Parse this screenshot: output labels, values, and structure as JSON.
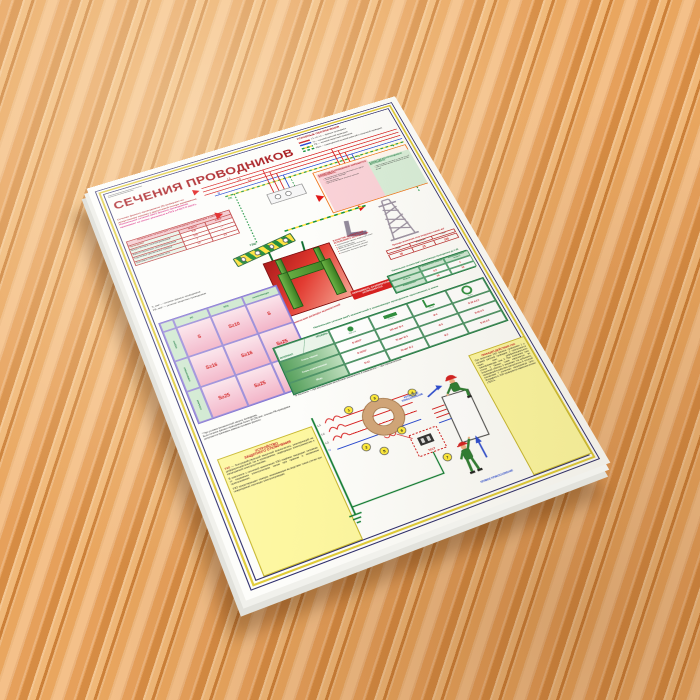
{
  "poster": {
    "title": "СЕЧЕНИЯ ПРОВОДНИКОВ",
    "legend": {
      "title": "УСЛОВНЫЕ ОБОЗНАЧЕНИЯ",
      "items": [
        {
          "label": "L1, L2, L3 — фазные проводники"
        },
        {
          "label": "N — нулевой рабочий проводник"
        },
        {
          "label": "PE — нулевой защитный проводник"
        },
        {
          "label": "PEN — совмещённый нулевой рабочий и защитный проводник"
        }
      ]
    },
    "intro": {
      "line1": "Сечение фазных проводников (S) выбирают по допустимому нагреву и допустимой потере напряжения.",
      "line2": "Наименьшие сечения (мм²) фазных проводников принимают не менее указанных в ПУЭ и ГОСТ Р 50571."
    },
    "wire_table": {
      "title": "Наименьшие сечения (мм²) токопроводящих жил проводов и кабелей",
      "headers": [
        "Проводники",
        "медных",
        "алюм."
      ],
      "rows": [
        {
          "name": "Шнуры бытовых электроприёмников",
          "cu": "0,35",
          "al": "—"
        },
        {
          "name": "Кабели переносных электроприёмников",
          "cu": "0,75",
          "al": "—"
        },
        {
          "name": "Скрученные двухжильные провода",
          "cu": "1",
          "al": "—"
        },
        {
          "name": "Групповые осветительные сети",
          "cu": "1,5",
          "al": "2,5"
        }
      ]
    },
    "schematic": {
      "phase_labels": [
        "L1",
        "L2",
        "L3"
      ],
      "n_label": "N",
      "pe_label": "PE",
      "gzsh_label": "ГЗШ"
    },
    "forbidden_pe_box": {
      "pink_title": "В КАЧЕСТВЕ PE-ПРОВОДНИКОВ ЗАПРЕЩАЕТСЯ ИСПОЛЬЗОВАТЬ:",
      "pink_items": [
        "металлические оболочки изоляционных трубок",
        "несущие тросы проводок",
        "металлорукава",
        "броню и свинцовые оболочки кабелей"
      ],
      "green_title": "В КАЧЕСТВЕ PEN-ПРОВОДНИКОВ ДОПУСКАЕТСЯ:",
      "green_items": [
        "шины медные сечением не менее 10 мм²",
        "шины алюминиевые сечением не менее 16 мм²"
      ]
    },
    "overhead_table": {
      "title": "Провода заземления опор воздушных линий, мм²",
      "headers": [
        "Медь",
        "Алюминий",
        "Сталь"
      ],
      "values": [
        "16",
        "25",
        "100"
      ]
    },
    "protective_table": {
      "title": "Наименьшие сечения (мм²) заземляющих проводников до 1 кВ",
      "headers": [
        "с механической защитой",
        "без механической защиты"
      ],
      "rows": [
        {
          "name": "Медные",
          "v1": "2,5",
          "v2": "4"
        },
        {
          "name": "Алюминиевые",
          "v1": "16",
          "v2": "16"
        }
      ]
    },
    "notes": {
      "s_line": "S, мм² — сечение фазных проводников",
      "pe_line": "PE, мм² — сечение защитных проводников"
    },
    "pe_table": {
      "col_headers": [
        "PE",
        "PEN",
        "заземляющие"
      ],
      "row_headers": [
        "медные",
        "алюминиевые",
        "стальные"
      ],
      "cells": [
        [
          "S",
          "S≥10",
          "S"
        ],
        [
          "S≥16",
          "S≥16",
          "S≥25"
        ],
        [
          "S≥25",
          "S≥25",
          "≤S*"
        ]
      ],
      "footnote1": "* При условии механической защиты проводника.",
      "footnote2": "Если сечение фазных проводников более 16 (25) мм², сечение PE-проводника допускается принимать равным половине фазного."
    },
    "grounding": {
      "caption": "Наименьшие размеры заземлителей",
      "paint_warning": "ОКРАШИВАТЬ ЗАЗЕМЛИТЕЛИ ЗАПРЕЩАЕТСЯ",
      "forbidden_title1": "В КАЧЕСТВЕ ЗАЗЕМЛИТЕЛЕЙ",
      "forbidden_title2": "ИСПОЛЬЗОВАТЬ ЗАПРЕЩАЕТСЯ:",
      "forbidden_items": [
        "трубопроводы горючих жидкостей и газов",
        "трубы канализации",
        "трубы центрального отопления",
        "алюминиевые оболочки кабелей",
        "свинцовые оболочки проводов"
      ]
    },
    "earth_table": {
      "title": "Наименьшие сечения (мм²) заземлителей и заземляющих проводников, проложенных в земле",
      "corner_top": "ПРОФИЛЬ",
      "corner_bottom": "МАТЕРИАЛ",
      "col_labels": [
        "Круглый",
        "Полоса",
        "Уголок",
        "Труба"
      ],
      "rows": [
        {
          "material": "Сталь чёрная",
          "round": "D-16/10*",
          "strip": "100 мм² Ф-4",
          "angle": "Ф-4",
          "pipe": "D-32 d-3,5"
        },
        {
          "material": "Сталь оцинкованная",
          "round": "D-12/10*",
          "strip": "75 мм² Ф-3",
          "angle": "Ф-3",
          "pipe": "D-25 d-2"
        },
        {
          "material": "Медь",
          "round": "D-12",
          "strip": "50 мм² Ф-2",
          "angle": "Ф-2",
          "pipe": "D-20 d-2"
        }
      ],
      "footnote": "* В числителе — при вертикальном заглублении заземлителя, в знаменателе — при горизонтальном."
    },
    "rcd_left": {
      "title1": "УСТРОЙСТВО",
      "title2": "ЗАЩИТНОГО ОТКЛЮЧЕНИЯ",
      "term": "УЗО",
      "body1": "— быстродействующий защитный выключатель, реагирующий на дифференциальный ток в проводниках, подводящих электроэнергию к защищаемой электроустановке.",
      "body2": "В комплексе с системой заземления УЗО надёжно защищает человека от поражения электрическим током при прямом и косвенном прикосновении.",
      "body3": "УЗО предотвращает пожары, возникающие вследствие токов утечки при повреждении изоляции электропроводки."
    },
    "rcd_right": {
      "title": "ПРИНЦИП ДЕЙСТВИЯ УЗО",
      "body": "При включении УЗО фазные проводники 1 и нулевой рабочий проводник 2 пропускаются через окно дифференциального трансформатора тока 3. При появлении тока утечки 4 баланс токов нарушается: во вторичной обмотке 5 возникает ток небаланса, приводящий в действие расцепитель 6, который контактами 7 отключает защищаемую цепь. Исправность УЗО проверяется нажатием кнопки «ТЕСТ»."
    },
    "circuit": {
      "labels": [
        "L1",
        "L2",
        "L3",
        "N"
      ],
      "numbers": [
        "1",
        "2",
        "3",
        "4",
        "5",
        "6",
        "7"
      ],
      "test_label": "ТЕСТ"
    },
    "touch": {
      "indirect": "КОСВЕННОЕ ПРИКОСНОВЕНИЕ",
      "direct": "ПРЯМОЕ ПРИКОСНОВЕНИЕ"
    }
  },
  "colors": {
    "frame_navy": "#2b2b6b",
    "frame_yellow": "#e0cb36",
    "accent_red": "#b01c20",
    "magenta": "#d4006a",
    "green": "#1d7a40",
    "busbar_yellow": "#ffe23a",
    "busbar_green": "#1d8a34",
    "note_yellow": "#fdf7a0",
    "wood": "#e2995a"
  }
}
